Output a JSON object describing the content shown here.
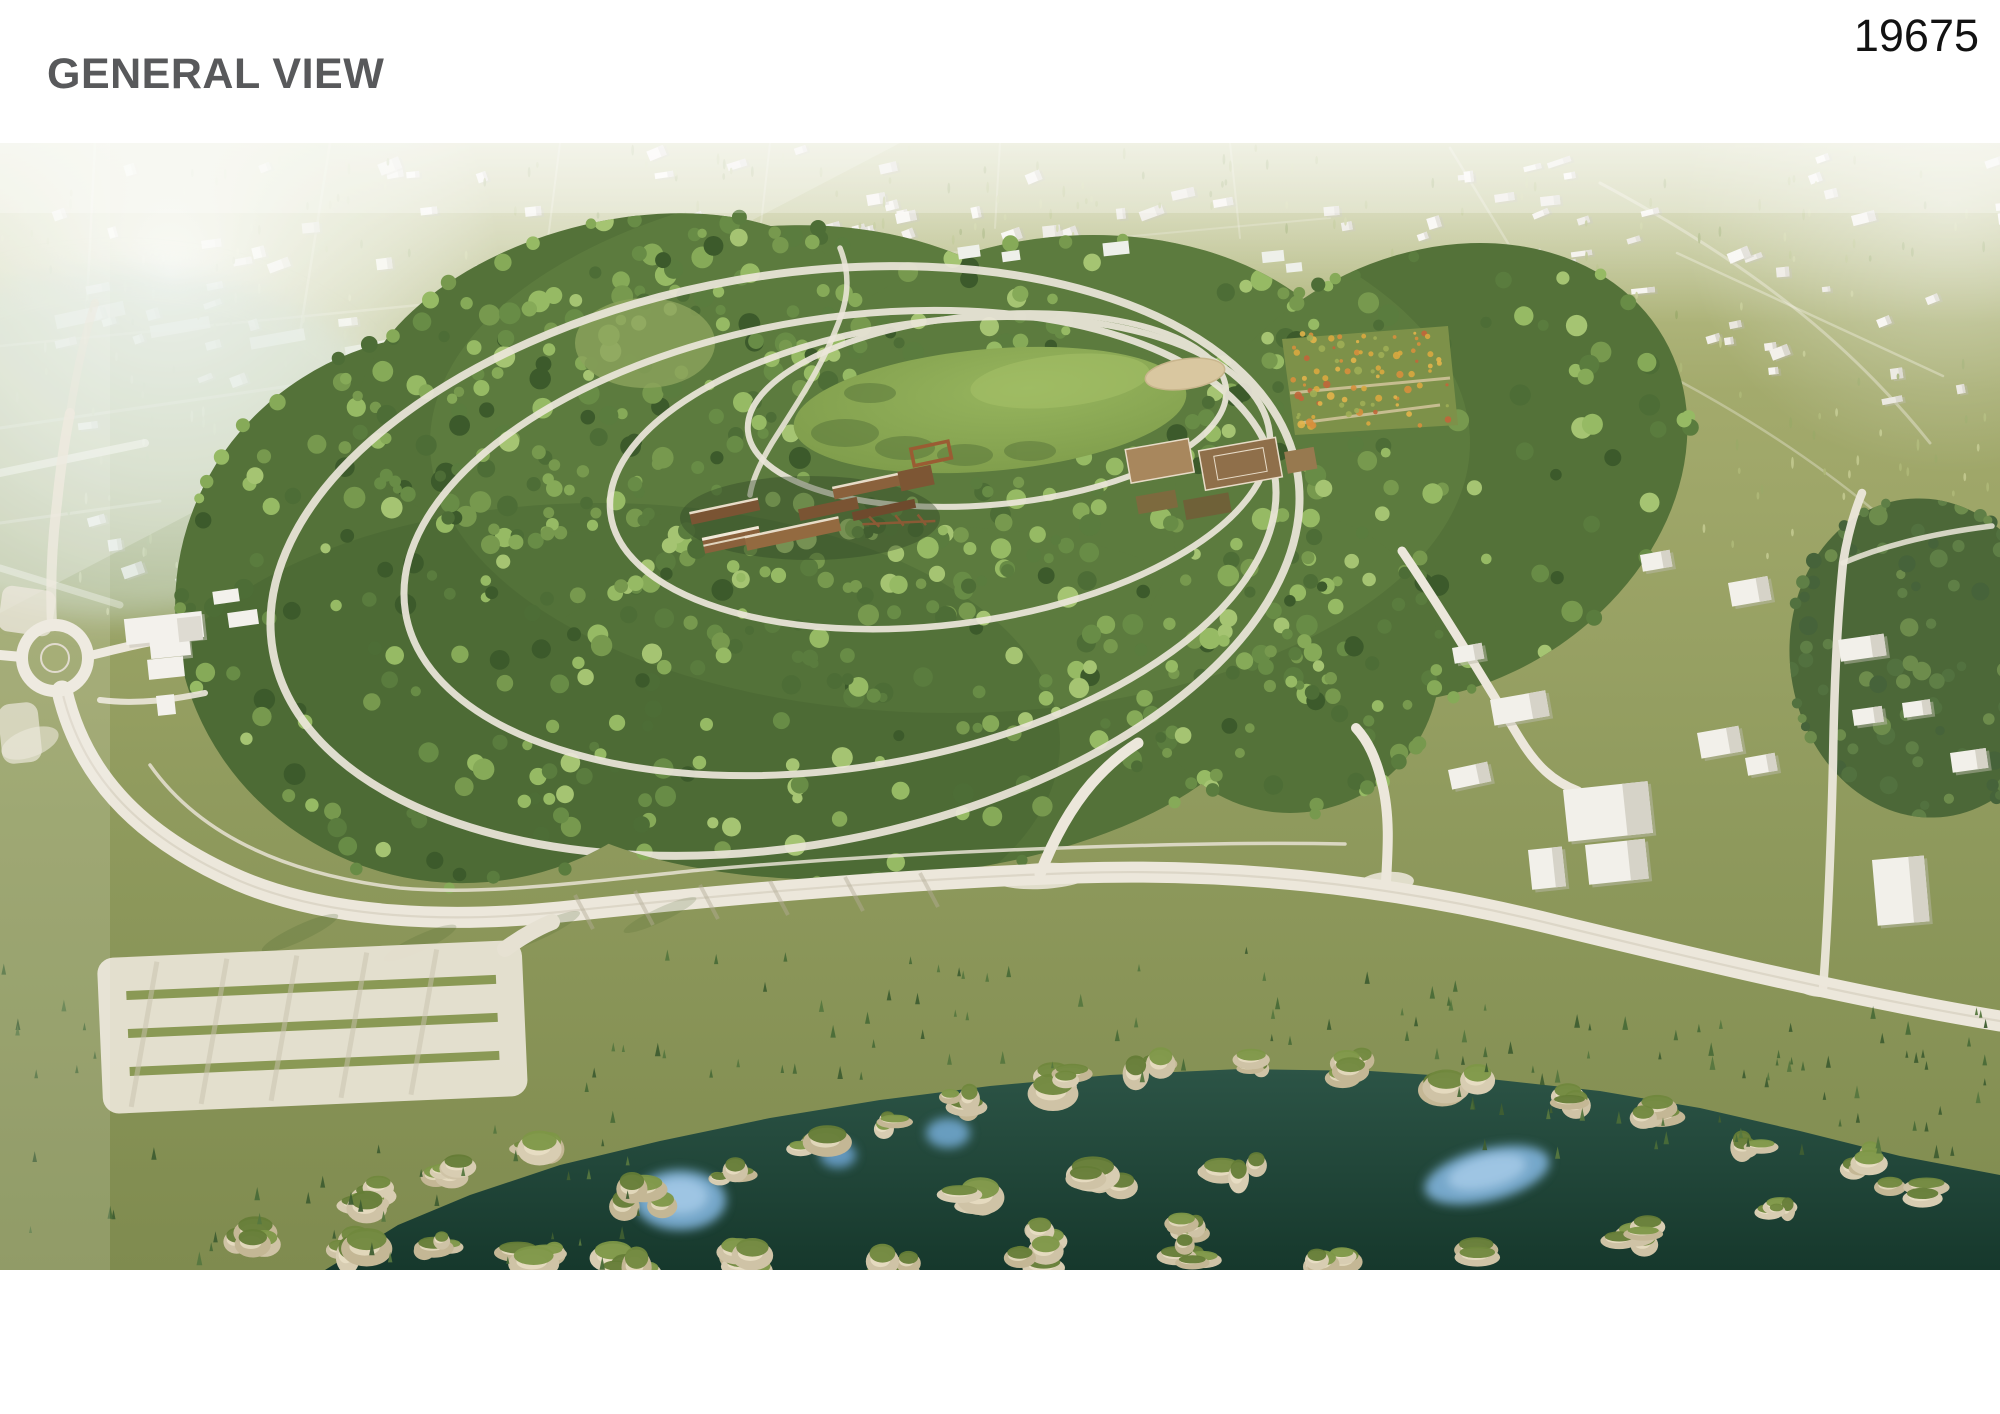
{
  "header": {
    "title": "GENERAL VIEW",
    "entry_number": "19675"
  },
  "colors": {
    "title": "#58595b",
    "entry_number": "#121212",
    "page_background": "#ffffff",
    "suburb_olive": "#a3aa6c",
    "forest_green": "#547239",
    "meadow_green": "#8fae57",
    "path_white": "#ece7db",
    "water_teal": "#24483a",
    "pool_blue": "#7fb2da",
    "rock_tan": "#d3c7ab",
    "timber_brown": "#8a613c",
    "sand_tan": "#d9c7a0"
  },
  "render": {
    "description": "Aerial bird's-eye 3D rendering of a large circular forested park surrounded by a low-rise suburban district. Inside the forest sit a central oval meadow with a sand oval, flower gardens, sports courts and long timber pavilion buildings, linked by white looping walking paths. A perimeter road with a roundabout and a striped parking lot borders the park on the left, and a rocky river gorge with dark green water, mossy cliffs and bright blue pools runs along the bottom of the view.",
    "labels": [
      "suburban district",
      "forest park",
      "central meadow",
      "sand oval",
      "flower garden",
      "sports courts",
      "timber pavilions",
      "walking loops",
      "roundabout",
      "perimeter road",
      "parking lot",
      "river gorge",
      "rock cliffs",
      "blue pools"
    ]
  }
}
